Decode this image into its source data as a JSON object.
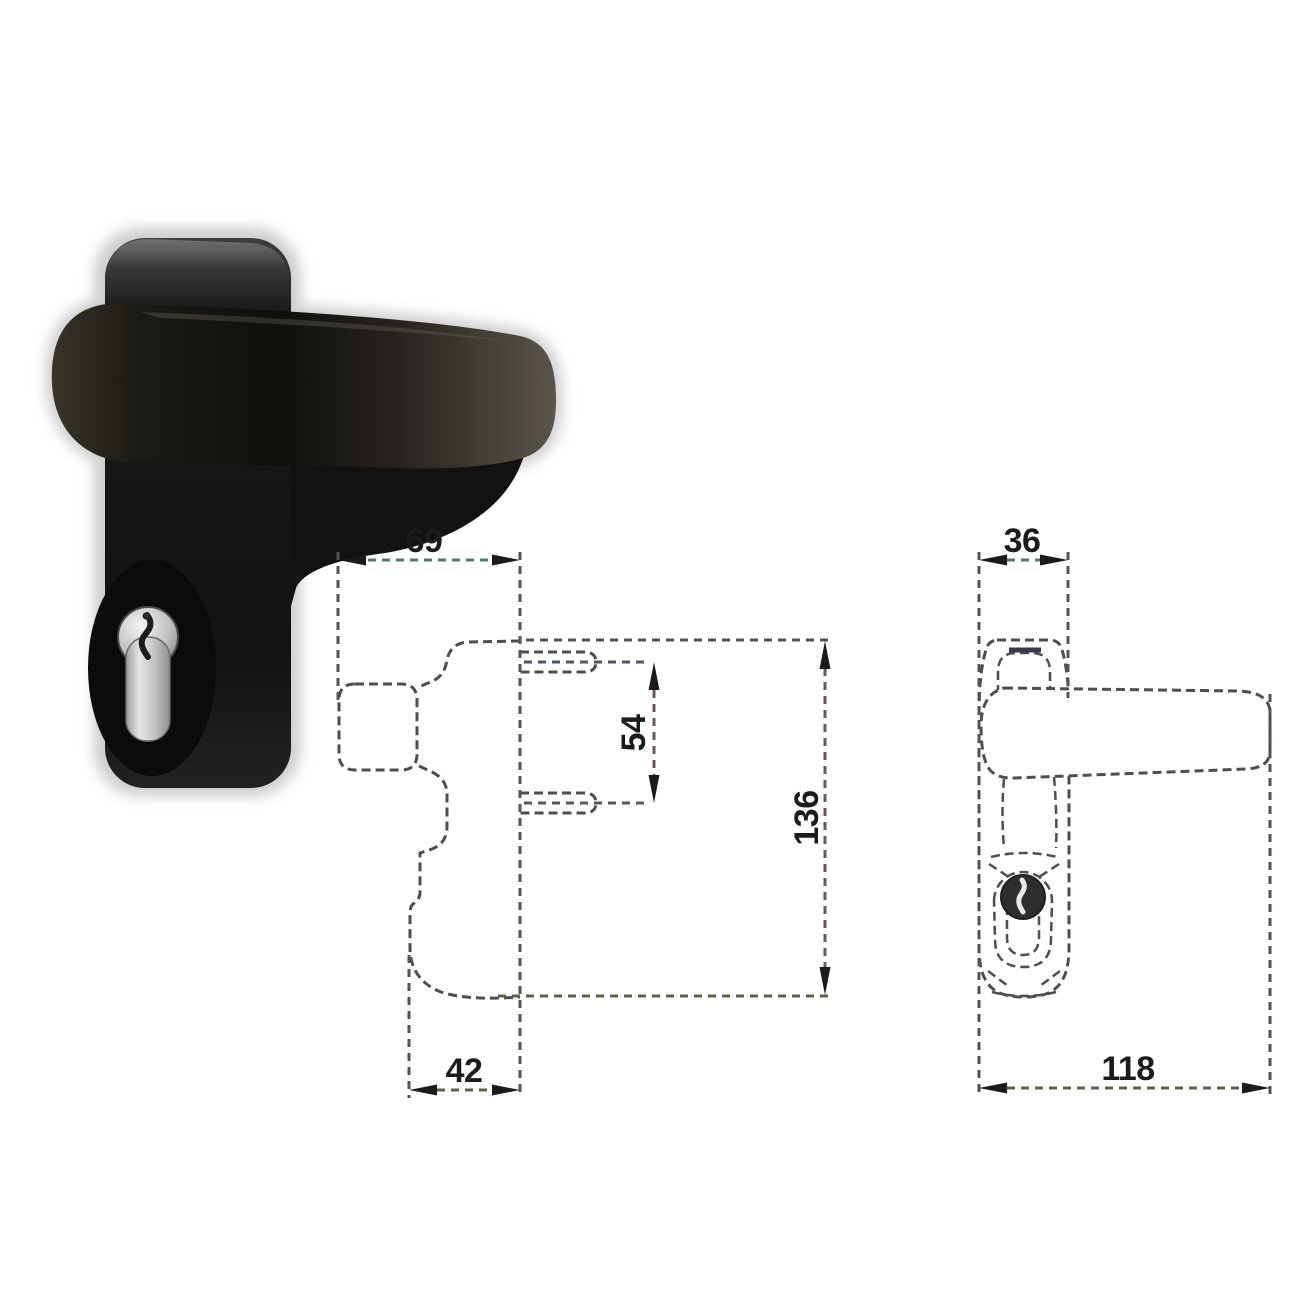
{
  "document": {
    "type": "product-technical-drawing",
    "subject": "black lever door handle with euro cylinder on backplate"
  },
  "photo": {
    "item": "black-lever-door-handle-photo",
    "features": [
      "backplate",
      "lever-grip",
      "euro-cylinder-keyhole"
    ]
  },
  "side_view": {
    "dims": {
      "projection": "69",
      "stud_spacing": "54",
      "height": "136",
      "lower_depth": "42"
    }
  },
  "front_view": {
    "dims": {
      "plate_width": "36",
      "length": "118"
    }
  },
  "colors": {
    "background": "#ffffff",
    "drawing_line": "#4e4e4e",
    "dimension_line": "#5c5c48",
    "arrow_and_text": "#1b1b1b",
    "handle_black": "#141210",
    "cylinder_silver": "#c6c6c6",
    "scan_halo": "#bfbfbf"
  }
}
